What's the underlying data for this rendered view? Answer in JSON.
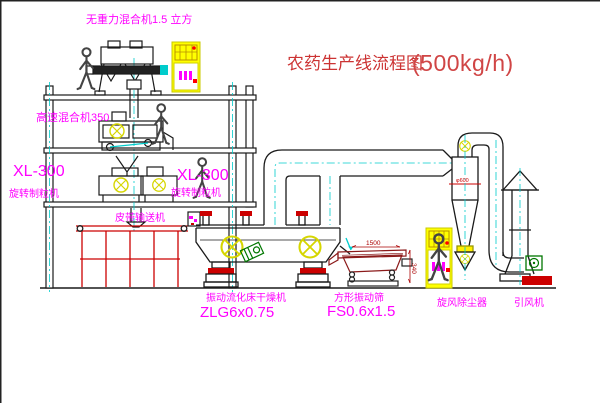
{
  "title": {
    "name": "农药生产线流程图",
    "capacity": "(500kg/h)"
  },
  "labels": {
    "gravityless_mixer": "无重力混合机1.5 立方",
    "high_speed_mixer": "高速混合机350",
    "granulator_left_model": "XL-300",
    "granulator_left_name": "旋转制粒机",
    "granulator_right_model": "XL-300",
    "granulator_right_name": "旋转制粒机",
    "belt_conveyor": "皮带输送机",
    "dryer_name": "振动流化床干燥机",
    "dryer_model": "ZLG6x0.75",
    "sieve_name": "方形振动筛",
    "sieve_model": "FS0.6x1.5",
    "cyclone": "旋风除尘器",
    "fan": "引风机"
  },
  "dimensions": {
    "sieve_length": "1500",
    "sieve_height": "340",
    "cyclone_diameter": "φ600"
  },
  "colors": {
    "label_magenta": "#ff00ff",
    "title_red": "#cc3333",
    "line_black": "#1a1a1a",
    "centerline_cyan": "#00cccc",
    "symbol_yellow": "#d6d600",
    "cabinet_yellow": "#ffff00",
    "accent_red": "#cc0000",
    "sieve_maroon": "#8b1a1a",
    "motor_green": "#007700"
  }
}
